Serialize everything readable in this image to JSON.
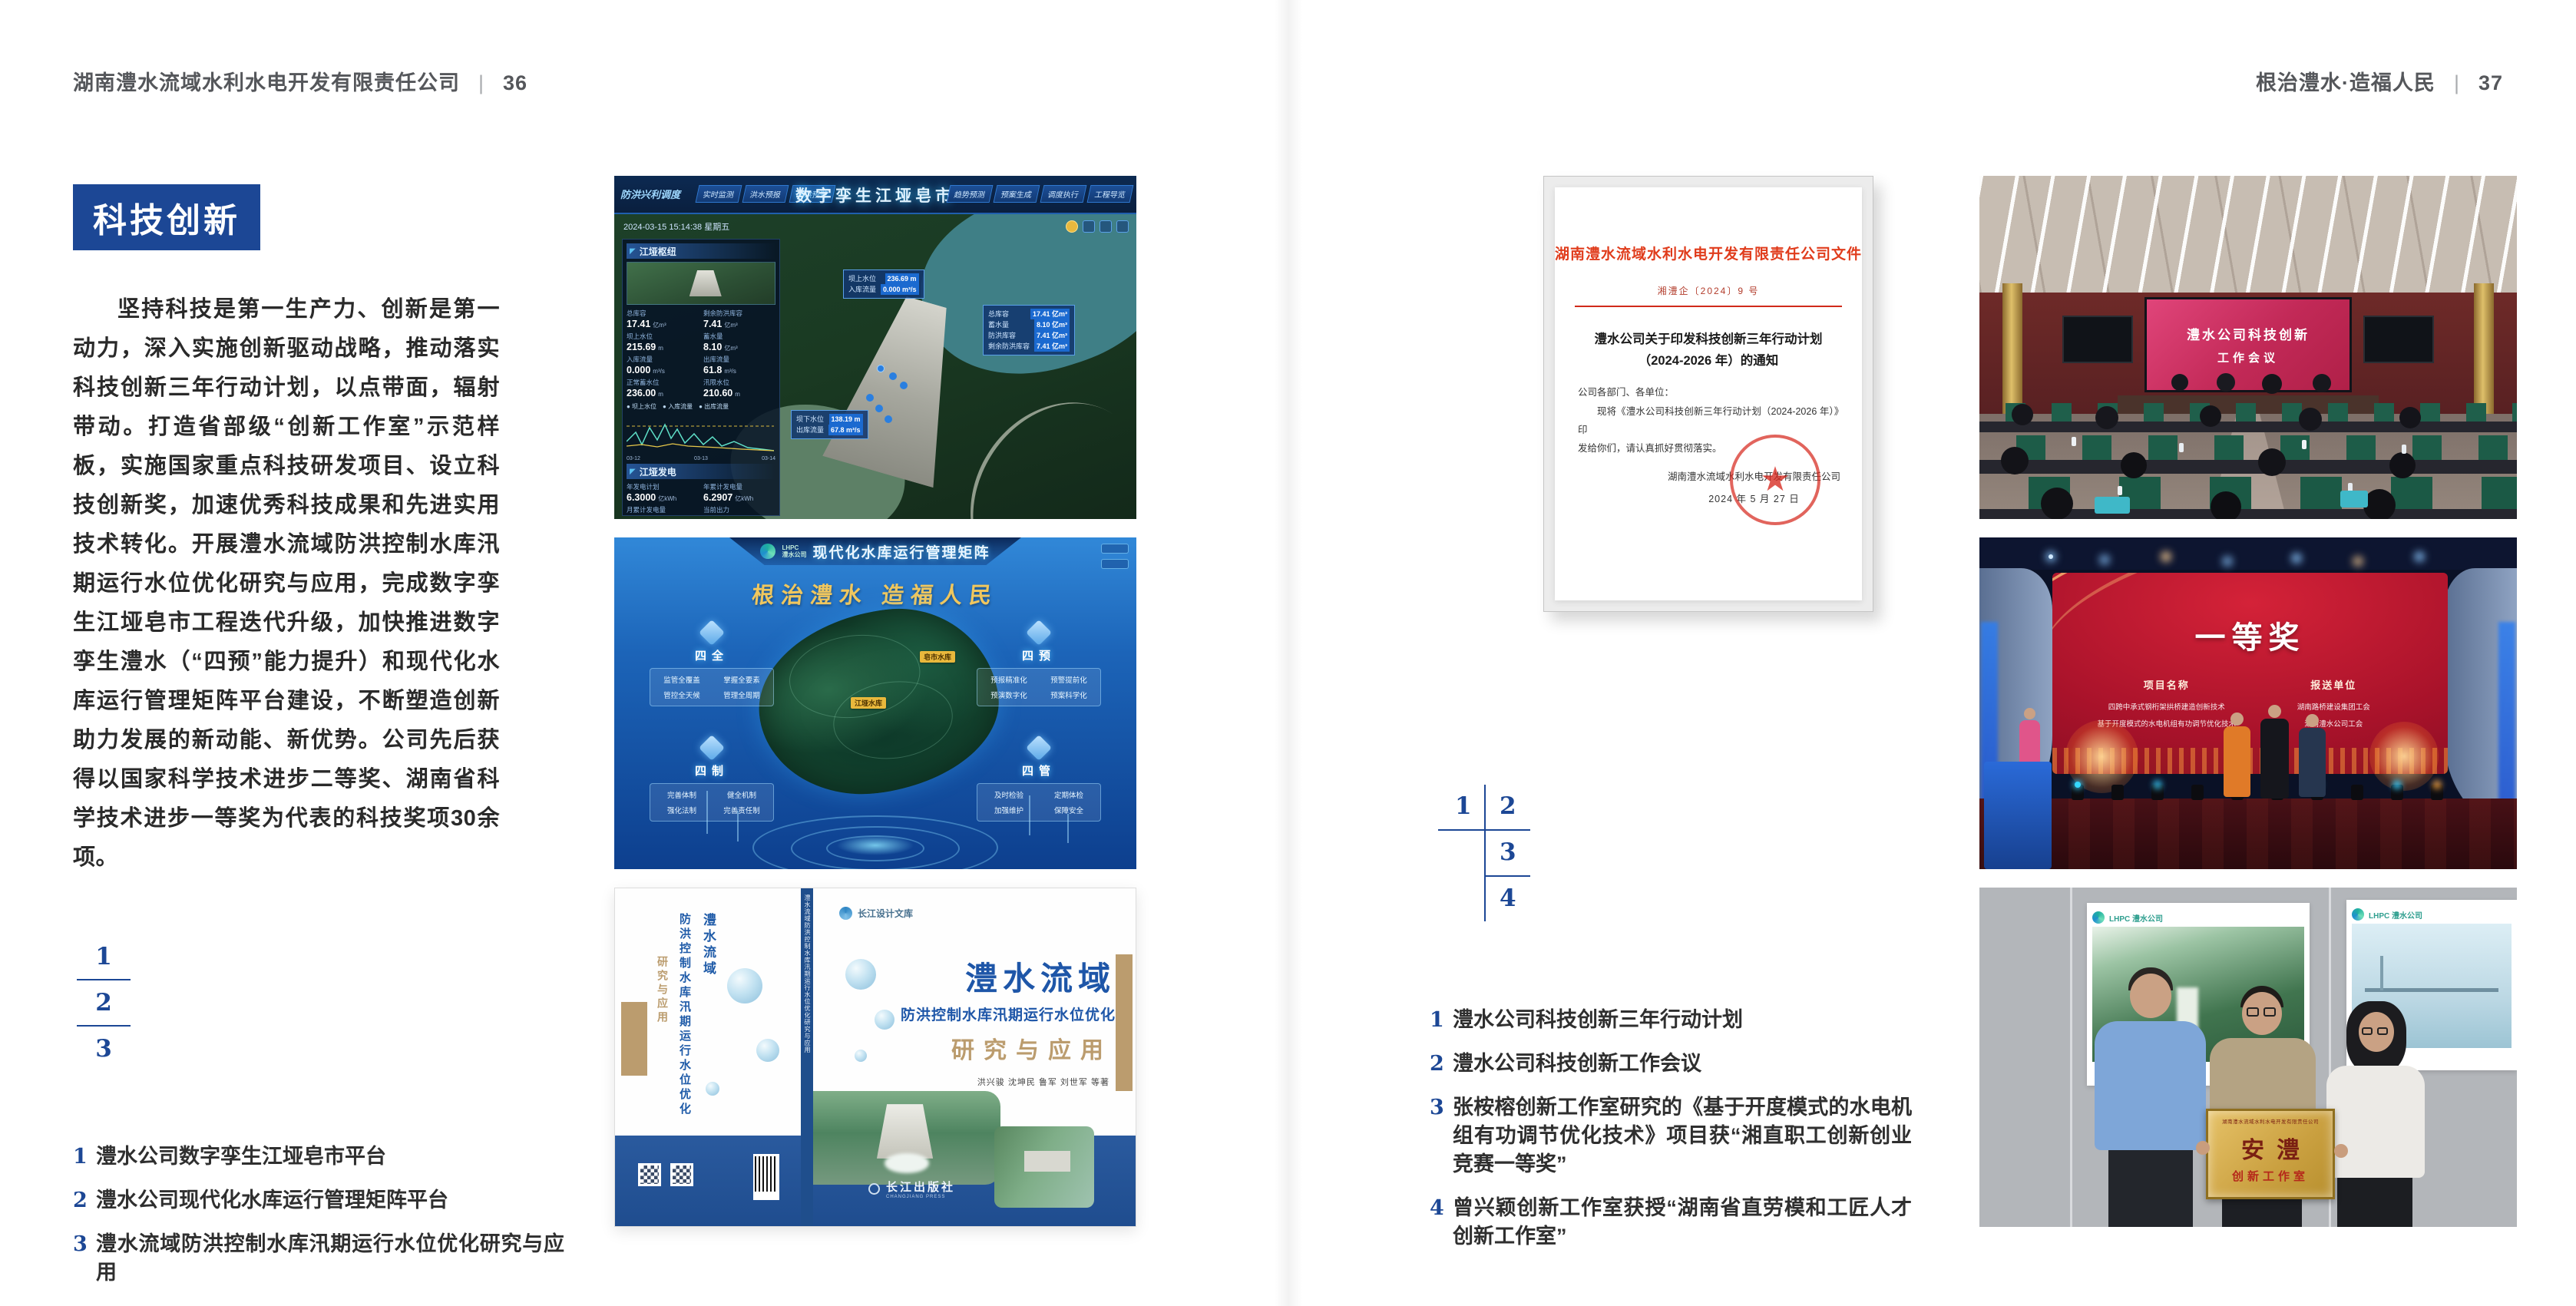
{
  "page_left": {
    "header": {
      "company": "湖南澧水流域水利水电开发有限责任公司",
      "divider": "|",
      "page_number": "36"
    },
    "section_title": "科技创新",
    "paragraph": "坚持科技是第一生产力、创新是第一动力，深入实施创新驱动战略，推动落实科技创新三年行动计划，以点带面，辐射带动。打造省部级“创新工作室”示范样板，实施国家重点科技研发项目、设立科技创新奖，加速优秀科技成果和先进实用技术转化。开展澧水流域防洪控制水库汛期运行水位优化研究与应用，完成数字孪生江垭皂市工程迭代升级，加快推进数字孪生澧水（“四预”能力提升）和现代化水库运行管理矩阵平台建设，不断塑造创新助力发展的新动能、新优势。公司先后获得以国家科学技术进步二等奖、湖南省科学技术进步一等奖为代表的科技奖项30余项。",
    "figure_index": {
      "n1": "1",
      "n2": "2",
      "n3": "3"
    },
    "captions": [
      {
        "num": "1",
        "text": "澧水公司数字孪生江垭皂市平台"
      },
      {
        "num": "2",
        "text": "澧水公司现代化水库运行管理矩阵平台"
      },
      {
        "num": "3",
        "text": "澧水流域防洪控制水库汛期运行水位优化研究与应用"
      }
    ]
  },
  "page_right": {
    "header": {
      "motto": "根治澧水·造福人民",
      "divider": "|",
      "page_number": "37"
    },
    "figure_index": {
      "n1": "1",
      "n2": "2",
      "n3": "3",
      "n4": "4"
    },
    "captions": [
      {
        "num": "1",
        "text": "澧水公司科技创新三年行动计划"
      },
      {
        "num": "2",
        "text": "澧水公司科技创新工作会议"
      },
      {
        "num": "3",
        "text": "张桉榕创新工作室研究的《基于开度模式的水电机组有功调节优化技术》项目获“湘直职工创新创业竞赛一等奖”"
      },
      {
        "num": "4",
        "text": "曾兴颖创新工作室获授“湖南省直劳模和工匠人才创新工作室”"
      }
    ]
  },
  "dashboard": {
    "mode_label": "防洪兴利调度",
    "title": "数字孪生江垭皂市",
    "tabs_left": {
      "t1": "实时监测",
      "t2": "洪水预报",
      "t3": "防洪预警"
    },
    "tabs_right": {
      "t1": "趋势预测",
      "t2": "预案生成",
      "t3": "调度执行",
      "t4": "工程导览"
    },
    "timestamp": "2024-03-15 15:14:38 星期五",
    "panel1_title": "江垭枢纽",
    "stats": [
      {
        "l": "总库容",
        "v": "17.41",
        "u": "亿m³"
      },
      {
        "l": "剩余防洪库容",
        "v": "7.41",
        "u": "亿m³"
      },
      {
        "l": "坝上水位",
        "v": "215.69",
        "u": "m"
      },
      {
        "l": "蓄水量",
        "v": "8.10",
        "u": "亿m³"
      },
      {
        "l": "入库流量",
        "v": "0.000",
        "u": "m³/s"
      },
      {
        "l": "出库流量",
        "v": "61.8",
        "u": "m³/s"
      },
      {
        "l": "正常蓄水位",
        "v": "236.00",
        "u": "m"
      },
      {
        "l": "汛限水位",
        "v": "210.60",
        "u": "m"
      }
    ],
    "legend": "● 坝上水位　● 入库流量　● 出库流量",
    "xlabels": {
      "x1": "03-12",
      "x2": "03-13",
      "x3": "03-14"
    },
    "panel2_title": "江垭发电",
    "stats2": [
      {
        "l": "年发电计划",
        "v": "6.3000",
        "u": "亿kWh"
      },
      {
        "l": "年累计发电量",
        "v": "6.2907",
        "u": "亿kWh"
      },
      {
        "l": "月累计发电量",
        "v": "3259.21",
        "u": "万kWh"
      },
      {
        "l": "当前出力",
        "v": "0.00",
        "u": "MW"
      }
    ],
    "units": [
      {
        "n": "1#机组",
        "v": "0.00"
      },
      {
        "n": "2#机组",
        "v": "100.58"
      },
      {
        "n": "3#机组",
        "v": "0.00"
      }
    ],
    "callout_top": [
      {
        "l": "坝上水位",
        "v": "236.69 m"
      },
      {
        "l": "入库流量",
        "v": "0.000 m³/s"
      }
    ],
    "callout_right": [
      {
        "l": "总库容",
        "v": "17.41 亿m³"
      },
      {
        "l": "蓄水量",
        "v": "8.10 亿m³"
      },
      {
        "l": "防洪库容",
        "v": "7.41 亿m³"
      },
      {
        "l": "剩余防洪库容",
        "v": "7.41 亿m³"
      }
    ],
    "callout_bottom": [
      {
        "l": "坝下水位",
        "v": "138.19 m"
      },
      {
        "l": "出库流量",
        "v": "67.8 m³/s"
      }
    ]
  },
  "platform": {
    "logo_line1": "LHPC",
    "logo_line2": "澧水公司",
    "title": "现代化水库运行管理矩阵",
    "slogan": "根治澧水 造福人民",
    "label_top": "皂市水库",
    "label_mid": "江垭水库",
    "groups": [
      {
        "title": "四全",
        "i1": "监管全覆盖",
        "i2": "掌握全要素",
        "i3": "管控全天候",
        "i4": "管理全周期"
      },
      {
        "title": "四预",
        "i1": "预报精准化",
        "i2": "预警提前化",
        "i3": "预演数字化",
        "i4": "预案科学化"
      },
      {
        "title": "四制",
        "i1": "完善体制",
        "i2": "健全机制",
        "i3": "强化法制",
        "i4": "完善责任制"
      },
      {
        "title": "四管",
        "i1": "及时检验",
        "i2": "定期体检",
        "i3": "加强维护",
        "i4": "保障安全"
      }
    ]
  },
  "book": {
    "series": "长江设计文库",
    "title1": "澧水流域",
    "title2": "防洪控制水库汛期运行水位优化",
    "title3": "研究与应用",
    "authors": "洪兴骏 沈坤民 鲁军 刘世军 等著",
    "spine_text": "澧水流域防洪控制水库汛期运行水位优化研究与应用",
    "back_line1": "澧水流域",
    "back_line2": "防洪控制水库汛期运行水位优化",
    "back_line3": "研究与应用",
    "publisher": "长江出版社",
    "publisher_en": "CHANGJIANG PRESS"
  },
  "doc": {
    "header": "湖南澧水流域水利水电开发有限责任公司文件",
    "number": "湘澧企〔2024〕9 号",
    "title_line1": "澧水公司关于印发科技创新三年行动计划",
    "title_line2": "（2024-2026 年）的通知",
    "salutation": "公司各部门、各单位：",
    "body_line1": "现将《澧水公司科技创新三年行动计划（2024-2026 年）》印",
    "body_line2": "发给你们，请认真抓好贯彻落实。",
    "signer": "湖南澧水流域水利水电开发有限责任公司",
    "date": "2024 年 5 月 27 日"
  },
  "meeting": {
    "screen_line1": "澧水公司科技创新",
    "screen_line2": "工作会议"
  },
  "award": {
    "title": "一等奖",
    "col1": "项目名称",
    "col2": "报送单位",
    "p1": "四跨中承式钢桁架拱桥建造创新技术",
    "p2": "基于开度模式的水电机组有功调节优化技术",
    "u1": "湖南路桥建设集团工会",
    "u2": "湖南澧水公司工会"
  },
  "plaque": {
    "poster_logo": "LHPC 澧水公司",
    "org": "湖南澧水流域水利水电开发有限责任公司",
    "big": "安澧",
    "sub": "创新工作室"
  }
}
